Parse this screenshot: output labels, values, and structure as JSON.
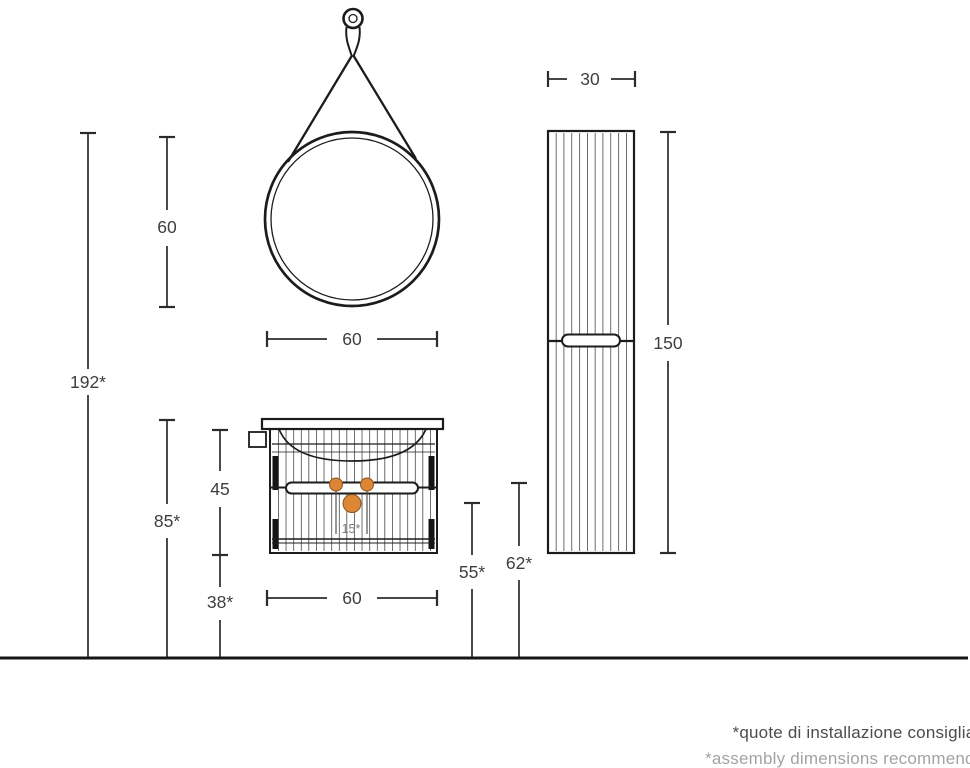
{
  "diagram_title": "bathroom-furniture-installation-dimensions",
  "dims": {
    "total_height": "192*",
    "mirror_height": "60",
    "mirror_width": "60",
    "worktop_height": "85*",
    "vanity_body_height": "45",
    "under_clearance": "38*",
    "vanity_width": "60",
    "drain_height": "55*",
    "supply_height": "62*",
    "column_height": "150",
    "column_width": "30",
    "connection_spacing": "15*"
  },
  "footnote": {
    "line1": "*quote di installazione consigliate",
    "line2": "*assembly dimensions recommended"
  },
  "colors": {
    "line": "#222222",
    "dim_line": "#2b2b2b",
    "label": "#3e3e3e",
    "accent_orange": "#dd8736",
    "accent_orange_edge": "#8a5420",
    "footnote_dark": "#4c4c4c",
    "footnote_light": "#a3a3a3"
  }
}
